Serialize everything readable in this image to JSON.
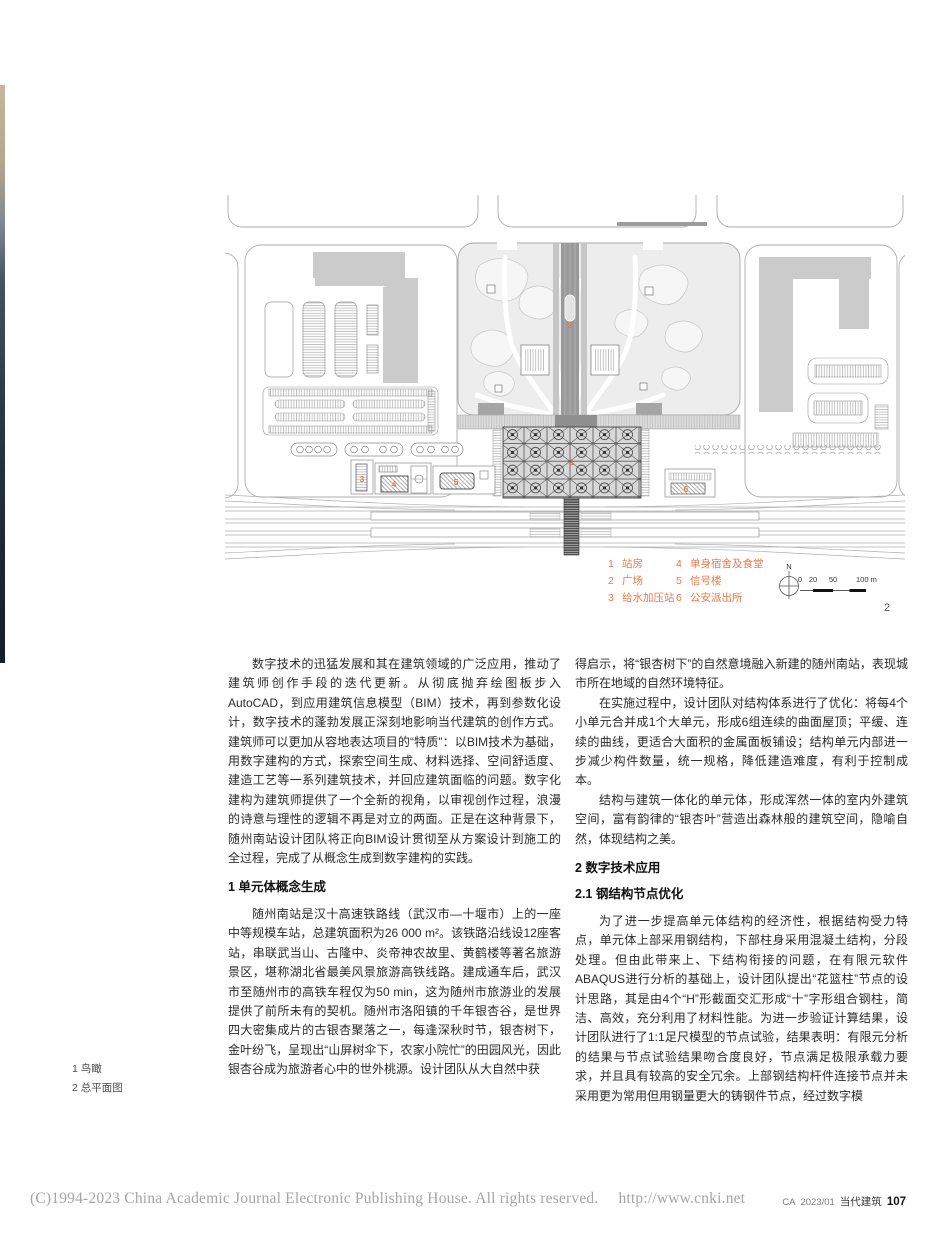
{
  "colors": {
    "accent_orange": "#e8794a",
    "plan_gray": "#cbcbcb",
    "line_gray": "#a8a8a8"
  },
  "figure": {
    "plan_labels": {
      "station": "1",
      "plaza": "2",
      "pump": "3",
      "dorm": "4",
      "signal": "5",
      "police": "6"
    },
    "legend": {
      "col1": [
        {
          "num": "1",
          "label": "站房"
        },
        {
          "num": "2",
          "label": "广场"
        },
        {
          "num": "3",
          "label": "给水加压站"
        }
      ],
      "col2": [
        {
          "num": "4",
          "label": "单身宿舍及食堂"
        },
        {
          "num": "5",
          "label": "信号楼"
        },
        {
          "num": "6",
          "label": "公安派出所"
        }
      ]
    },
    "north_label": "N",
    "scalebar": {
      "ticks": [
        "0",
        "20",
        "50",
        "100 m"
      ]
    },
    "figure_number": "2",
    "captions": [
      "1 鸟瞰",
      "2 总平面图"
    ]
  },
  "article": {
    "left_column": {
      "p1": "数字技术的迅猛发展和其在建筑领域的广泛应用，推动了建筑师创作手段的迭代更新。从彻底抛弃绘图板步入AutoCAD，到应用建筑信息模型（BIM）技术，再到参数化设计，数字技术的蓬勃发展正深刻地影响当代建筑的创作方式。建筑师可以更加从容地表达项目的“特质”：以BIM技术为基础，用数字建构的方式，探索空间生成、材料选择、空间舒适度、建造工艺等一系列建筑技术，并回应建筑面临的问题。数字化建构为建筑师提供了一个全新的视角，以审视创作过程，浪漫的诗意与理性的逻辑不再是对立的两面。正是在这种背景下，随州南站设计团队将正向BIM设计贯彻至从方案设计到施工的全过程，完成了从概念生成到数字建构的实践。",
      "h1": "1 单元体概念生成",
      "p2": "随州南站是汉十高速铁路线（武汉市—十堰市）上的一座中等规模车站，总建筑面积为26 000 m²。该铁路沿线设12座客站，串联武当山、古隆中、炎帝神农故里、黄鹤楼等著名旅游景区，堪称湖北省最美风景旅游高铁线路。建成通车后，武汉市至随州市的高铁车程仅为50 min，这为随州市旅游业的发展提供了前所未有的契机。随州市洛阳镇的千年银杏谷，是世界四大密集成片的古银杏聚落之一，每逢深秋时节，银杏树下，金叶纷飞，呈现出“山屏树伞下，农家小院忙”的田园风光，因此银杏谷成为旅游者心中的世外桃源。设计团队从大自然中获"
    },
    "right_column": {
      "p3": "得启示，将“银杏树下”的自然意境融入新建的随州南站，表现城市所在地域的自然环境特征。",
      "p4": "在实施过程中，设计团队对结构体系进行了优化：将每4个小单元合并成1个大单元，形成6组连续的曲面屋顶；平缓、连续的曲线，更适合大面积的金属面板铺设；结构单元内部进一步减少构件数量，统一规格，降低建造难度，有利于控制成本。",
      "p5": "结构与建筑一体化的单元体，形成浑然一体的室内外建筑空间，富有韵律的“银杏叶”营造出森林般的建筑空间，隐喻自然，体现结构之美。",
      "h2": "2 数字技术应用",
      "h21": "2.1 钢结构节点优化",
      "p6": "为了进一步提高单元体结构的经济性，根据结构受力特点，单元体上部采用钢结构，下部柱身采用混凝土结构，分段处理。但由此带来上、下结构衔接的问题，在有限元软件ABAQUS进行分析的基础上，设计团队提出“花篮柱”节点的设计思路，其是由4个“H”形截面交汇形成“十”字形组合钢柱，简洁、高效，充分利用了材料性能。为进一步验证计算结果，设计团队进行了1:1足尺模型的节点试验，结果表明：有限元分析的结果与节点试验结果吻合度良好，节点满足极限承载力要求，并且具有较高的安全冗余。上部钢结构杆件连接节点并未采用更为常用但用钢量更大的铸钢件节点，经过数字模"
    }
  },
  "footer": {
    "left": "(C)1994-2023 China Academic Journal Electronic Publishing House. All rights reserved.",
    "url": "http://www.cnki.net",
    "journal_code": "CA",
    "issue": "2023/01",
    "journal_name": "当代建筑",
    "page_number": "107"
  }
}
